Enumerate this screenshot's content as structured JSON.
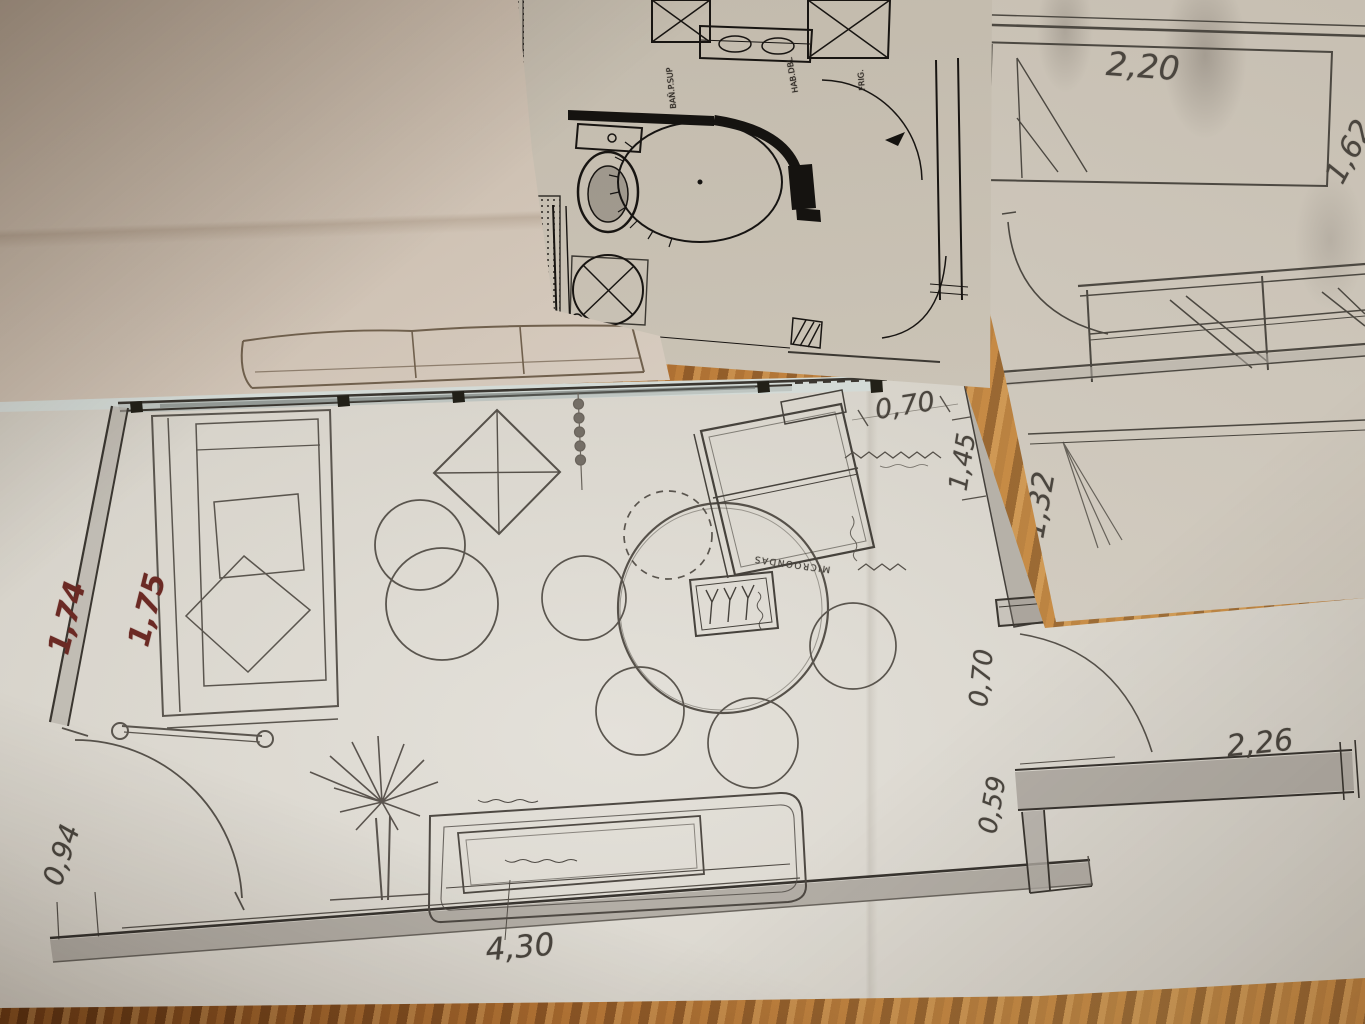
{
  "scene": {
    "setting": "overlapping hand-drawn floor-plan sheets photographed on a wooden table"
  },
  "colors": {
    "wood": "#a96a2e",
    "paper_blank": "#d6cbbf",
    "paper_print": "#c9c2b5",
    "paper_right": "#cfc8bc",
    "paper_living": "#dcd8d0",
    "ink": "#181512",
    "pencil": "#56514a",
    "red_ink": "#6b2a24",
    "blue_edge": "#d3dad6"
  },
  "sheets": {
    "bedroom": {
      "dims": {
        "bed_width": "2,20",
        "right_edge_partial": "1,62",
        "closet_depth": "1,32"
      }
    },
    "bathroom_print": {
      "labels": {
        "room_tag_1": "BAÑ.P.SUP",
        "room_tag_2": "HAB.DBL",
        "room_tag_3": "FRIG."
      }
    },
    "living_kitchen": {
      "dims": {
        "top_right_opening": "0,70",
        "right_wall_vertical": "1,45",
        "left_red_outer": "1,74",
        "left_red_inner": "1,75",
        "left_lower": "0,94",
        "bottom_width": "4,30",
        "right_door_width": "0,70",
        "right_lower_wall": "0,59",
        "right_bottom_width": "2,26"
      },
      "labels": {
        "kitchen_counter": "MICROONDAS"
      }
    }
  }
}
